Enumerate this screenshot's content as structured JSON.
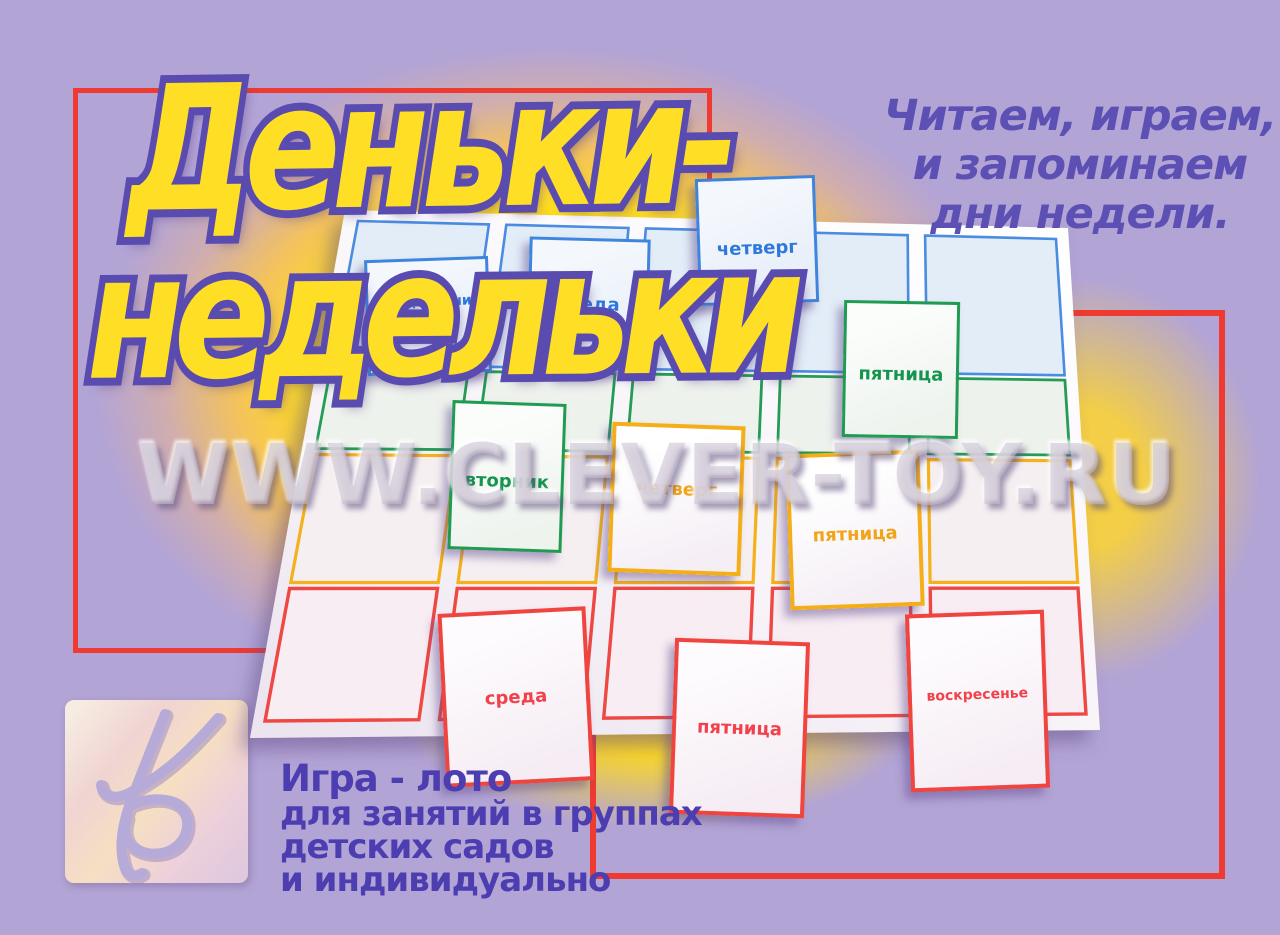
{
  "page": {
    "background_color": "#b3a4d6",
    "glow_color": "#ffde1e",
    "frame_color": "#ee3a30"
  },
  "title": {
    "line1": "Деньки-",
    "line2": "недельки",
    "fill_color": "#ffdf26",
    "outline_color": "#5a4bb0"
  },
  "tagline": {
    "lines": [
      "Читаем, играем,",
      "и запоминаем",
      "дни недели."
    ],
    "color": "#5c50b4"
  },
  "watermark": {
    "text": "WWW.CLEVER-TOY.RU"
  },
  "description": {
    "lines": [
      "Игра - лото",
      "для занятий в группах",
      "детских садов",
      "и индивидуально"
    ],
    "color": "#4c3db0"
  },
  "board": {
    "rows": [
      {
        "name": "blue-row",
        "line_color": "#4a8ce0",
        "fill": "#e3edf8",
        "cells": 5
      },
      {
        "name": "green-row",
        "line_color": "#249c55",
        "fill": "#eef2ed",
        "cells": 5
      },
      {
        "name": "orange-row",
        "line_color": "#f5b11b",
        "fill": "#f6eff2",
        "cells": 5
      },
      {
        "name": "red-row",
        "line_color": "#ef4742",
        "fill": "#f8edf3",
        "cells": 5
      }
    ]
  },
  "cards": [
    {
      "label": "понедельник",
      "color": "blue"
    },
    {
      "label": "среда",
      "color": "blue"
    },
    {
      "label": "четверг",
      "color": "blue"
    },
    {
      "label": "пятница",
      "color": "green"
    },
    {
      "label": "вторник",
      "color": "green"
    },
    {
      "label": "четверг",
      "color": "orange"
    },
    {
      "label": "пятница",
      "color": "orange"
    },
    {
      "label": "среда",
      "color": "red"
    },
    {
      "label": "пятница",
      "color": "red"
    },
    {
      "label": "воскресенье",
      "color": "red"
    }
  ],
  "card_colors": {
    "blue": {
      "border": "#3f85de",
      "text": "#2e78dc"
    },
    "green": {
      "border": "#1f9b52",
      "text": "#13954e"
    },
    "orange": {
      "border": "#f4ae17",
      "text": "#f3a416"
    },
    "red": {
      "border": "#f0453f",
      "text": "#f2414a"
    }
  },
  "logo": {
    "name": "clever-toy-publisher-logo"
  }
}
